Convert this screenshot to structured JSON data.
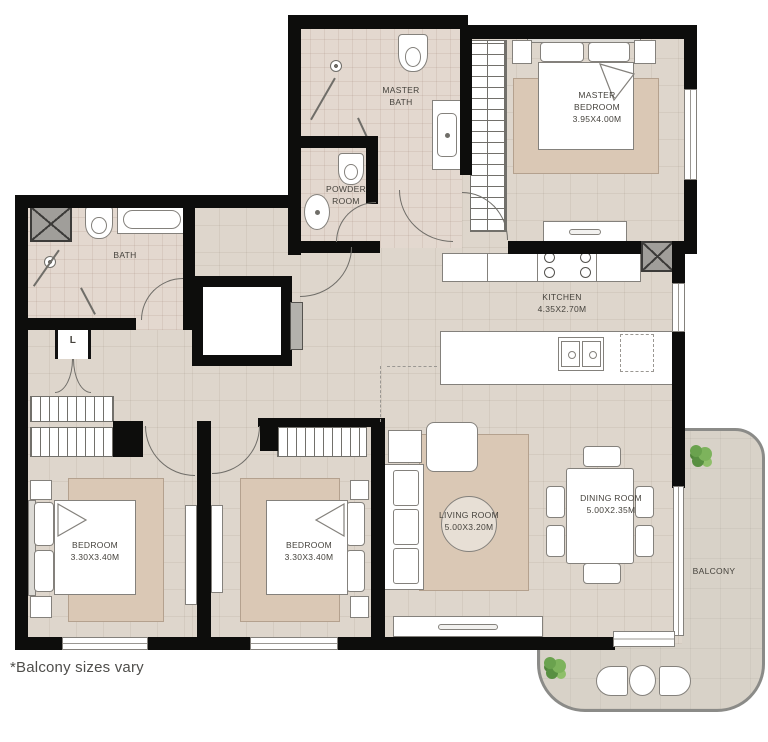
{
  "title": "apartment-floor-plan",
  "footnote": "*Balcony sizes vary",
  "rooms": {
    "master_bath": {
      "name": "MASTER BATH"
    },
    "master_bedroom": {
      "name": "MASTER BEDROOM",
      "dims": "3.95X4.00M"
    },
    "powder_room": {
      "name": "POWDER ROOM"
    },
    "bath": {
      "name": "BATH"
    },
    "laundry": {
      "name": "L"
    },
    "kitchen": {
      "name": "KITCHEN",
      "dims": "4.35X2.70M"
    },
    "living_room": {
      "name": "LIVING ROOM",
      "dims": "5.00X3.20M"
    },
    "dining_room": {
      "name": "DINING ROOM",
      "dims": "5.00X2.35M"
    },
    "bedroom_1": {
      "name": "BEDROOM",
      "dims": "3.30X3.40M"
    },
    "bedroom_2": {
      "name": "BEDROOM",
      "dims": "3.30X3.40M"
    },
    "balcony": {
      "name": "BALCONY"
    }
  },
  "colors": {
    "wall": "#0d0d0c",
    "floor": "#ded6cc",
    "floor_bath": "#e3d8cf",
    "rug": "#dac8b5",
    "balcony_floor": "#d8d2c8",
    "balcony_border": "#8b8b88",
    "plant": "#6aa24e",
    "furniture_outline": "#84817c",
    "label_text": "#45423c"
  }
}
